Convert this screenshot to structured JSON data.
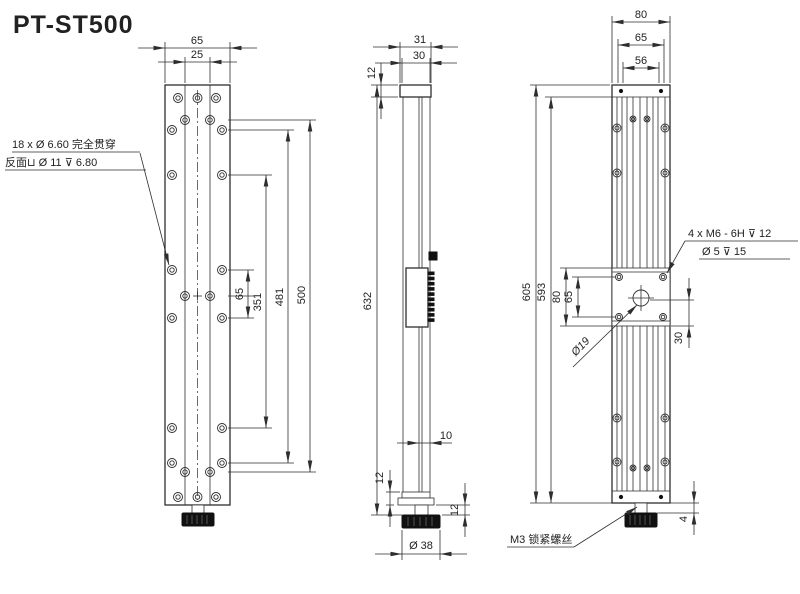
{
  "title": "PT-ST500",
  "front_view": {
    "dims": {
      "top_outer": "65",
      "top_inner": "25",
      "hole_pair": "65",
      "span_351": "351",
      "span_481": "481",
      "span_500": "500"
    },
    "hole_note": {
      "line1": "18 x Ø 6.60 完全贯穿",
      "line2": "反面⊔ Ø 11 ⊽ 6.80"
    }
  },
  "side_view": {
    "dims": {
      "cap_outer": "31",
      "cap_inner": "30",
      "cap_height": "12",
      "total": "632",
      "rod": "10",
      "foot_left": "12",
      "foot_right": "12",
      "knob_dia": "Ø 38"
    }
  },
  "rear_view": {
    "dims": {
      "top_outer": "80",
      "top_mid": "65",
      "top_inner": "56",
      "total_outer": "605",
      "total_inner": "593",
      "carriage_outer": "80",
      "carriage_inner": "65",
      "offset": "30",
      "base_gap": "4"
    },
    "thread_note": {
      "line1": "4 x M6 - 6H ⊽ 12",
      "line2": "Ø 5 ⊽ 15"
    },
    "center_hole_label": "Ø19",
    "lock_screw_note": "M3 锁紧螺丝"
  },
  "colors": {
    "line": "#2e2e2e",
    "background": "#ffffff",
    "knob": "#111111"
  }
}
